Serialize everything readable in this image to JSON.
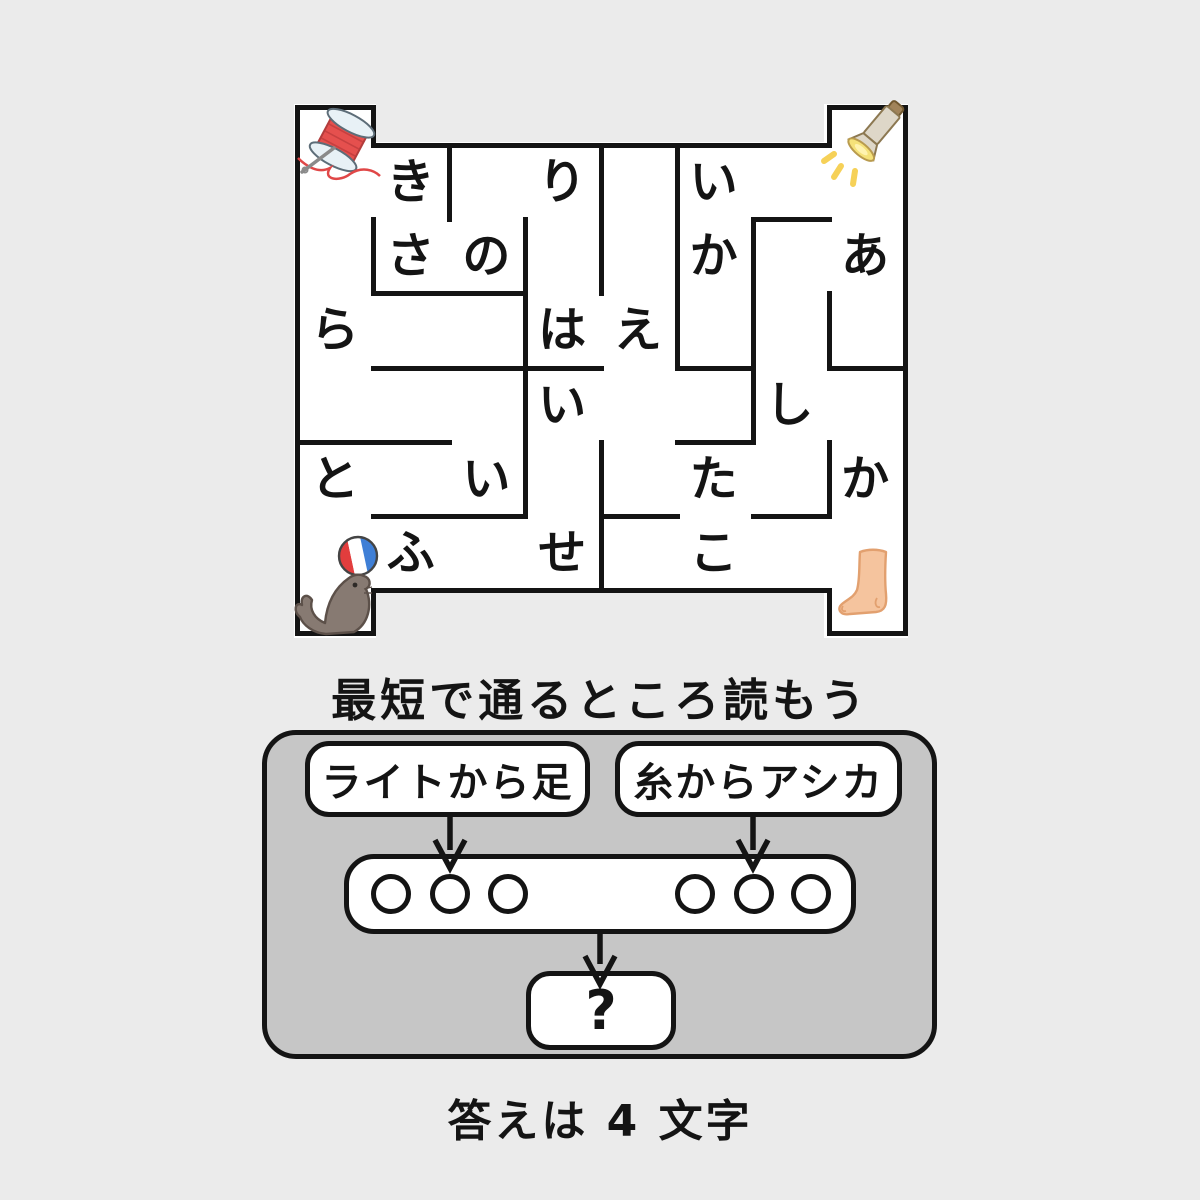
{
  "page": {
    "background_color": "#ebebeb",
    "panel_color": "#c6c6c6",
    "wall_color": "#141414",
    "box_color": "#ffffff"
  },
  "maze": {
    "grid": {
      "columns": 8,
      "rows": 6,
      "x0": 297,
      "y0": 145,
      "cell_width": 75.75,
      "cell_height": 74.17
    },
    "letters": [
      {
        "char": "き",
        "col": 2,
        "row": 1
      },
      {
        "char": "り",
        "col": 4,
        "row": 1
      },
      {
        "char": "い",
        "col": 6,
        "row": 1
      },
      {
        "char": "さ",
        "col": 2,
        "row": 2
      },
      {
        "char": "の",
        "col": 3,
        "row": 2
      },
      {
        "char": "か",
        "col": 6,
        "row": 2
      },
      {
        "char": "あ",
        "col": 8,
        "row": 2
      },
      {
        "char": "ら",
        "col": 1,
        "row": 3
      },
      {
        "char": "は",
        "col": 4,
        "row": 3
      },
      {
        "char": "え",
        "col": 5,
        "row": 3
      },
      {
        "char": "い",
        "col": 4,
        "row": 4
      },
      {
        "char": "し",
        "col": 7,
        "row": 4
      },
      {
        "char": "と",
        "col": 1,
        "row": 5
      },
      {
        "char": "い",
        "col": 3,
        "row": 5
      },
      {
        "char": "た",
        "col": 6,
        "row": 5
      },
      {
        "char": "か",
        "col": 8,
        "row": 5
      },
      {
        "char": "ふ",
        "col": 2,
        "row": 6
      },
      {
        "char": "せ",
        "col": 4,
        "row": 6
      },
      {
        "char": "こ",
        "col": 6,
        "row": 6
      }
    ],
    "walls": [
      {
        "x1": 297,
        "y1": 107,
        "x2": 297,
        "y2": 633
      },
      {
        "x1": 905,
        "y1": 107,
        "x2": 905,
        "y2": 633
      },
      {
        "x1": 373,
        "y1": 107,
        "x2": 373,
        "y2": 145
      },
      {
        "x1": 829,
        "y1": 107,
        "x2": 829,
        "y2": 145
      },
      {
        "x1": 373,
        "y1": 590,
        "x2": 373,
        "y2": 633
      },
      {
        "x1": 829,
        "y1": 590,
        "x2": 829,
        "y2": 633
      },
      {
        "x1": 449,
        "y1": 145,
        "x2": 449,
        "y2": 219
      },
      {
        "x1": 373,
        "y1": 219,
        "x2": 373,
        "y2": 293
      },
      {
        "x1": 525,
        "y1": 219,
        "x2": 525,
        "y2": 516
      },
      {
        "x1": 601,
        "y1": 145,
        "x2": 601,
        "y2": 293
      },
      {
        "x1": 601,
        "y1": 442,
        "x2": 601,
        "y2": 590
      },
      {
        "x1": 677,
        "y1": 145,
        "x2": 677,
        "y2": 368
      },
      {
        "x1": 753,
        "y1": 219,
        "x2": 753,
        "y2": 442
      },
      {
        "x1": 829,
        "y1": 293,
        "x2": 829,
        "y2": 368
      },
      {
        "x1": 829,
        "y1": 442,
        "x2": 829,
        "y2": 516
      },
      {
        "x1": 297,
        "y1": 107,
        "x2": 373,
        "y2": 107
      },
      {
        "x1": 829,
        "y1": 107,
        "x2": 905,
        "y2": 107
      },
      {
        "x1": 373,
        "y1": 145,
        "x2": 829,
        "y2": 145
      },
      {
        "x1": 297,
        "y1": 633,
        "x2": 373,
        "y2": 633
      },
      {
        "x1": 829,
        "y1": 633,
        "x2": 905,
        "y2": 633
      },
      {
        "x1": 373,
        "y1": 590,
        "x2": 829,
        "y2": 590
      },
      {
        "x1": 753,
        "y1": 219,
        "x2": 829,
        "y2": 219
      },
      {
        "x1": 373,
        "y1": 293,
        "x2": 525,
        "y2": 293
      },
      {
        "x1": 373,
        "y1": 368,
        "x2": 601,
        "y2": 368
      },
      {
        "x1": 677,
        "y1": 368,
        "x2": 753,
        "y2": 368
      },
      {
        "x1": 829,
        "y1": 368,
        "x2": 905,
        "y2": 368
      },
      {
        "x1": 297,
        "y1": 442,
        "x2": 449,
        "y2": 442
      },
      {
        "x1": 677,
        "y1": 442,
        "x2": 753,
        "y2": 442
      },
      {
        "x1": 373,
        "y1": 516,
        "x2": 525,
        "y2": 516
      },
      {
        "x1": 601,
        "y1": 516,
        "x2": 677,
        "y2": 516
      },
      {
        "x1": 753,
        "y1": 516,
        "x2": 829,
        "y2": 516
      }
    ],
    "corner_icons": [
      {
        "name": "thread-spool",
        "corner": "top-left"
      },
      {
        "name": "flashlight",
        "corner": "top-right"
      },
      {
        "name": "sea-lion-with-ball",
        "corner": "bottom-left"
      },
      {
        "name": "foot",
        "corner": "bottom-right"
      }
    ]
  },
  "instruction": "最短で通るところ読もう",
  "flow": {
    "left_label": "ライトから足",
    "right_label": "糸からアシカ",
    "left_circles": 3,
    "right_circles": 3,
    "result_label": "?"
  },
  "answer_note": "答えは 4 文字"
}
